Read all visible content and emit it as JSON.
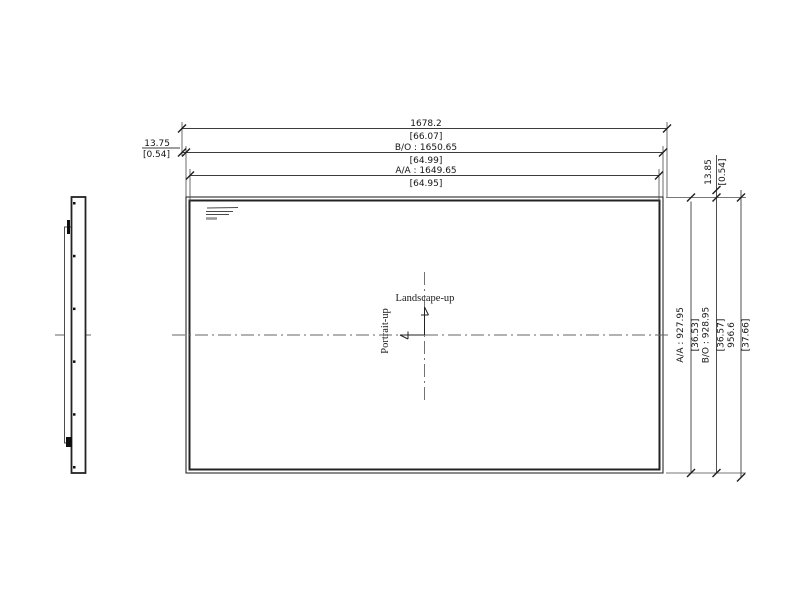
{
  "drawing": {
    "title": "panel-outline-dimension-drawing",
    "colors": {
      "background": "#ffffff",
      "line": "#2b2b2b",
      "dim_line": "#3c3c3c",
      "centerline": "#646464",
      "text": "#151515"
    },
    "orientation": {
      "landscape_label": "Landscape-up",
      "portrait_label": "Portrait-up"
    },
    "dimensions": {
      "top_overall": {
        "mm": "1678.2",
        "inch": "[66.07]"
      },
      "top_bo": {
        "mm": "B/O : 1650.65",
        "inch": "[64.99]"
      },
      "top_aa": {
        "mm": "A/A : 1649.65",
        "inch": "[64.95]"
      },
      "left_offset": {
        "mm": "13.75",
        "inch": "[0.54]"
      },
      "right_aa": {
        "mm": "A/A : 927.95",
        "inch": "[36.53]"
      },
      "right_bo": {
        "mm": "B/O : 928.95",
        "inch": "[36.57]"
      },
      "right_overall": {
        "mm": "956.6",
        "inch": "[37.66]"
      },
      "top_right_offset": {
        "mm": "13.85",
        "inch": "[0.54]"
      }
    }
  }
}
